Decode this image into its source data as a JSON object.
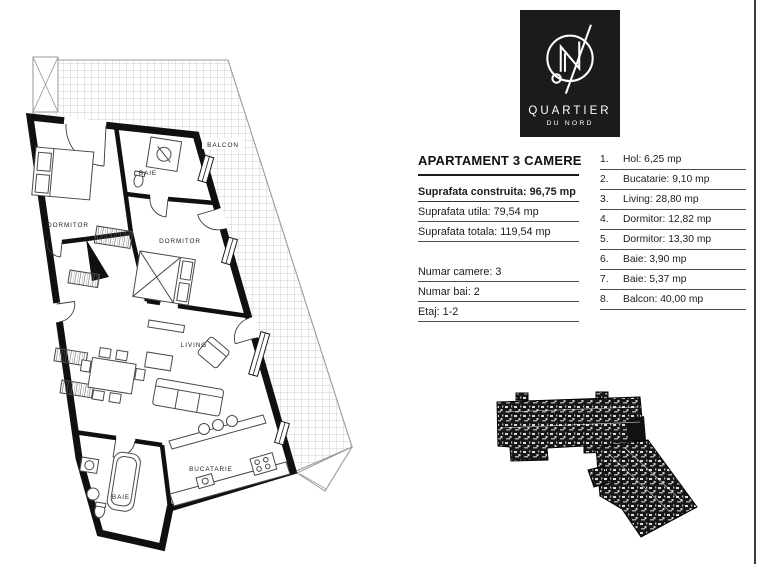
{
  "logo": {
    "brand": "QUARTIER",
    "subtitle_prefix": "du",
    "subtitle_word": "NORD",
    "bg_color": "#1d1a1b",
    "fg_color": "#ffffff"
  },
  "details": {
    "title": "APARTAMENT 3 CAMERE",
    "primary": [
      {
        "text": "Suprafata construita: 96,75 mp",
        "bold": true
      },
      {
        "text": "Suprafata utila: 79,54 mp",
        "bold": false
      },
      {
        "text": "Suprafata totala: 119,54 mp",
        "bold": false
      }
    ],
    "secondary": [
      {
        "text": "Numar camere: 3"
      },
      {
        "text": "Numar bai: 2"
      },
      {
        "text": "Etaj: 1-2"
      }
    ]
  },
  "rooms": {
    "items": [
      {
        "nr": "1.",
        "label": "Hol: 6,25 mp"
      },
      {
        "nr": "2.",
        "label": "Bucatarie: 9,10 mp"
      },
      {
        "nr": "3.",
        "label": "Living: 28,80 mp"
      },
      {
        "nr": "4.",
        "label": "Dormitor: 12,82 mp"
      },
      {
        "nr": "5.",
        "label": "Dormitor: 13,30 mp"
      },
      {
        "nr": "6.",
        "label": "Baie: 3,90 mp"
      },
      {
        "nr": "7.",
        "label": "Baie: 5,37 mp"
      },
      {
        "nr": "8.",
        "label": "Balcon: 40,00 mp"
      }
    ]
  },
  "plan": {
    "labels": {
      "balcon": "BALCON",
      "dormitor1": "DORMITOR",
      "baie1": "BAIE",
      "dormitor2": "DORMITOR",
      "living": "LIVING",
      "bucatarie": "BUCATARIE",
      "baie2": "BAIE"
    },
    "colors": {
      "wall": "#101010",
      "hatch_line": "#bdbdbd",
      "boundary": "#9a9a9a",
      "furniture": "#4a4a4a",
      "keyplan_fill": "#171717",
      "page_edge": "#3a3a3a"
    }
  }
}
